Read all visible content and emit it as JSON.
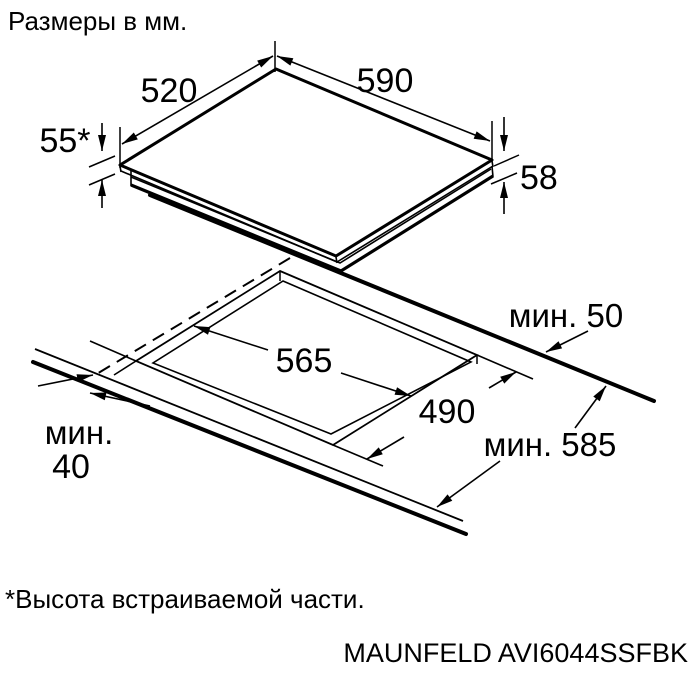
{
  "title": "Размеры в мм.",
  "footnote": "*Высота встраиваемой части.",
  "model": "MAUNFELD AVI6044SSFBK",
  "colors": {
    "line": "#000000",
    "background": "#ffffff"
  },
  "dimensions": {
    "cooktop_width": "590",
    "cooktop_depth": "520",
    "built_in_height": "55*",
    "total_height": "58",
    "cutout_width": "565",
    "cutout_depth": "490",
    "min_rear_clearance": "мин. 50",
    "min_worktop_depth": "мин. 585",
    "min_front_clearance_word": "мин.",
    "min_front_clearance_value": "40"
  }
}
